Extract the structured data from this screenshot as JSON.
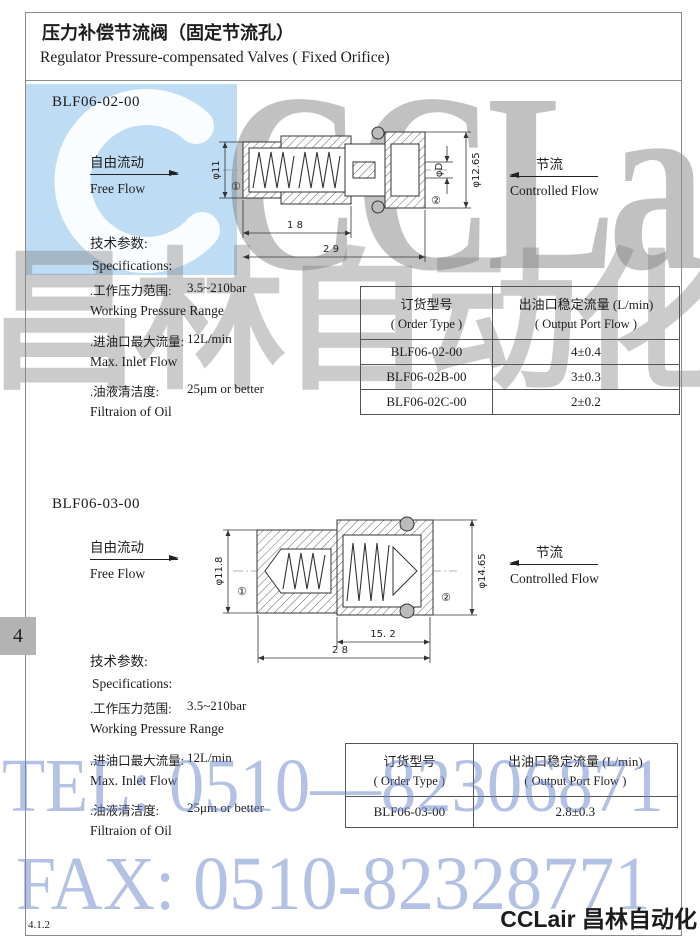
{
  "page": {
    "title_cn": "压力补偿节流阀（固定节流孔）",
    "title_en": "Regulator Pressure-compensated Valves ( Fixed Orifice)",
    "page_tab": "4",
    "doc_number": "4.1.2",
    "footer_brand": "CCLair 昌林自动化"
  },
  "watermarks": {
    "brand_latin": "CCLair",
    "brand_cn": "昌林自动化",
    "tel": "TEL: 0510—82306871",
    "fax": "FAX: 0510-82328771",
    "colors": {
      "blue_text": "#6a84cc",
      "gray_text": "#808080",
      "logo_blue": "#bedcf4"
    }
  },
  "sections": [
    {
      "model": "BLF06-02-00",
      "free_flow_cn": "自由流动",
      "free_flow_en": "Free Flow",
      "controlled_flow_cn": "节流",
      "controlled_flow_en": "Controlled Flow",
      "drawing": {
        "dia_left": "φ11",
        "port1": "①",
        "port2": "②",
        "dia_orifice": "φD",
        "dia_right": "φ12.65",
        "len_inner": "1 8",
        "len_total": "2 9"
      },
      "specs_heading_cn": "技术参数:",
      "specs_heading_en": "Specifications:",
      "specs": [
        {
          "cn": ".工作压力范围:",
          "en": "Working Pressure Range",
          "value": "3.5~210bar"
        },
        {
          "cn": ".进油口最大流量:",
          "en": "Max. Inlet Flow",
          "value": "12L/min"
        },
        {
          "cn": ".油液清洁度:",
          "en": "Filtraion of Oil",
          "value": "25μm or better"
        }
      ],
      "table": {
        "col1_cn": "订货型号",
        "col1_en": "( Order Type )",
        "col2_cn": "出油口稳定流量 (L/min)",
        "col2_en": "( Output Port Flow )",
        "rows": [
          {
            "type": "BLF06-02-00",
            "flow": "4±0.4"
          },
          {
            "type": "BLF06-02B-00",
            "flow": "3±0.3"
          },
          {
            "type": "BLF06-02C-00",
            "flow": "2±0.2"
          }
        ]
      }
    },
    {
      "model": "BLF06-03-00",
      "free_flow_cn": "自由流动",
      "free_flow_en": "Free Flow",
      "controlled_flow_cn": "节流",
      "controlled_flow_en": "Controlled Flow",
      "drawing": {
        "dia_left": "φ11.8",
        "port1": "①",
        "port2": "②",
        "dia_right": "φ14.65",
        "len_inner": "15. 2",
        "len_total": "2 8"
      },
      "specs_heading_cn": "技术参数:",
      "specs_heading_en": "Specifications:",
      "specs": [
        {
          "cn": ".工作压力范围:",
          "en": "Working Pressure Range",
          "value": "3.5~210bar"
        },
        {
          "cn": ".进油口最大流量:",
          "en": "Max. Inlet Flow",
          "value": "12L/min"
        },
        {
          "cn": ".油液清洁度:",
          "en": "Filtraion of Oil",
          "value": "25μm or better"
        }
      ],
      "table": {
        "col1_cn": "订货型号",
        "col1_en": "( Order Type )",
        "col2_cn": "出油口稳定流量 (L/min)",
        "col2_en": "( Output Port Flow )",
        "rows": [
          {
            "type": "BLF06-03-00",
            "flow": "2.8±0.3"
          }
        ]
      }
    }
  ]
}
